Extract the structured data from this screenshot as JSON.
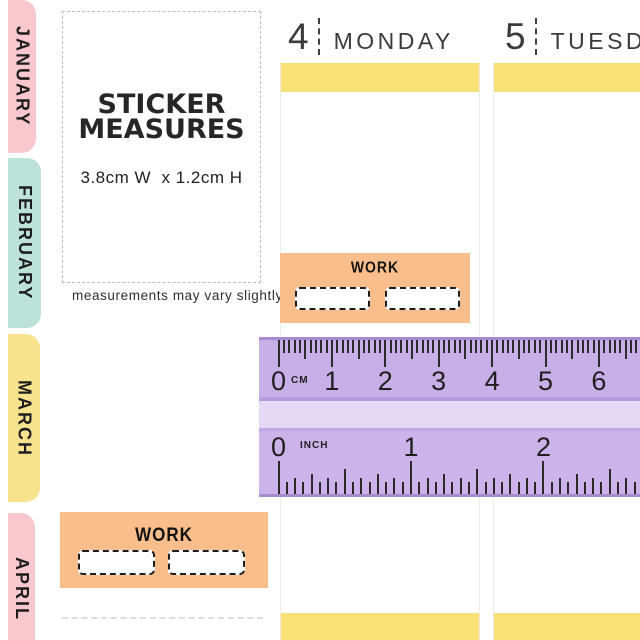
{
  "month_tabs": [
    {
      "label": "JANUARY",
      "color": "#F8C8CE"
    },
    {
      "label": "FEBRUARY",
      "color": "#BDE2D9"
    },
    {
      "label": "MARCH",
      "color": "#F7E38D"
    },
    {
      "label": "APRIL",
      "color": "#F8C8CE"
    }
  ],
  "columns": [
    {
      "date": "4",
      "day": "MONDAY"
    },
    {
      "date": "5",
      "day": "TUESDAY"
    }
  ],
  "measure_box": {
    "title_line1": "STICKER",
    "title_line2": "MEASURES",
    "dimensions": "3.8cm W  x 1.2cm H",
    "caption": "measurements may vary slightly"
  },
  "work_sticker": {
    "label": "WORK",
    "blank_box_count": 2
  },
  "ruler": {
    "cm_unit_label": "CM",
    "inch_unit_label": "INCH",
    "cm_numbers": [
      "0",
      "1",
      "2",
      "3",
      "4",
      "5",
      "6"
    ],
    "inch_numbers": [
      "0",
      "1",
      "2"
    ],
    "mm_step_px": 5.34,
    "sixteenth_step_px": 8.28,
    "origin_px": 19.5
  },
  "colors": {
    "bar_yellow": "#F9E275",
    "sticker_orange": "#F9BE8B",
    "ruler_body": "#C9AFE7",
    "ruler_inch_zone": "#CCB3EA",
    "ruler_pale_band": "#E4DAF5",
    "ruler_edge": "#A78BCE",
    "ruler_separator": "#B79BE0",
    "ruler_separator2": "#C0A6E3",
    "tick": "#2B2B2B",
    "tab_pink": "#F8C8CE",
    "tab_mint": "#BDE2D9",
    "tab_yellow": "#F7E38D"
  }
}
